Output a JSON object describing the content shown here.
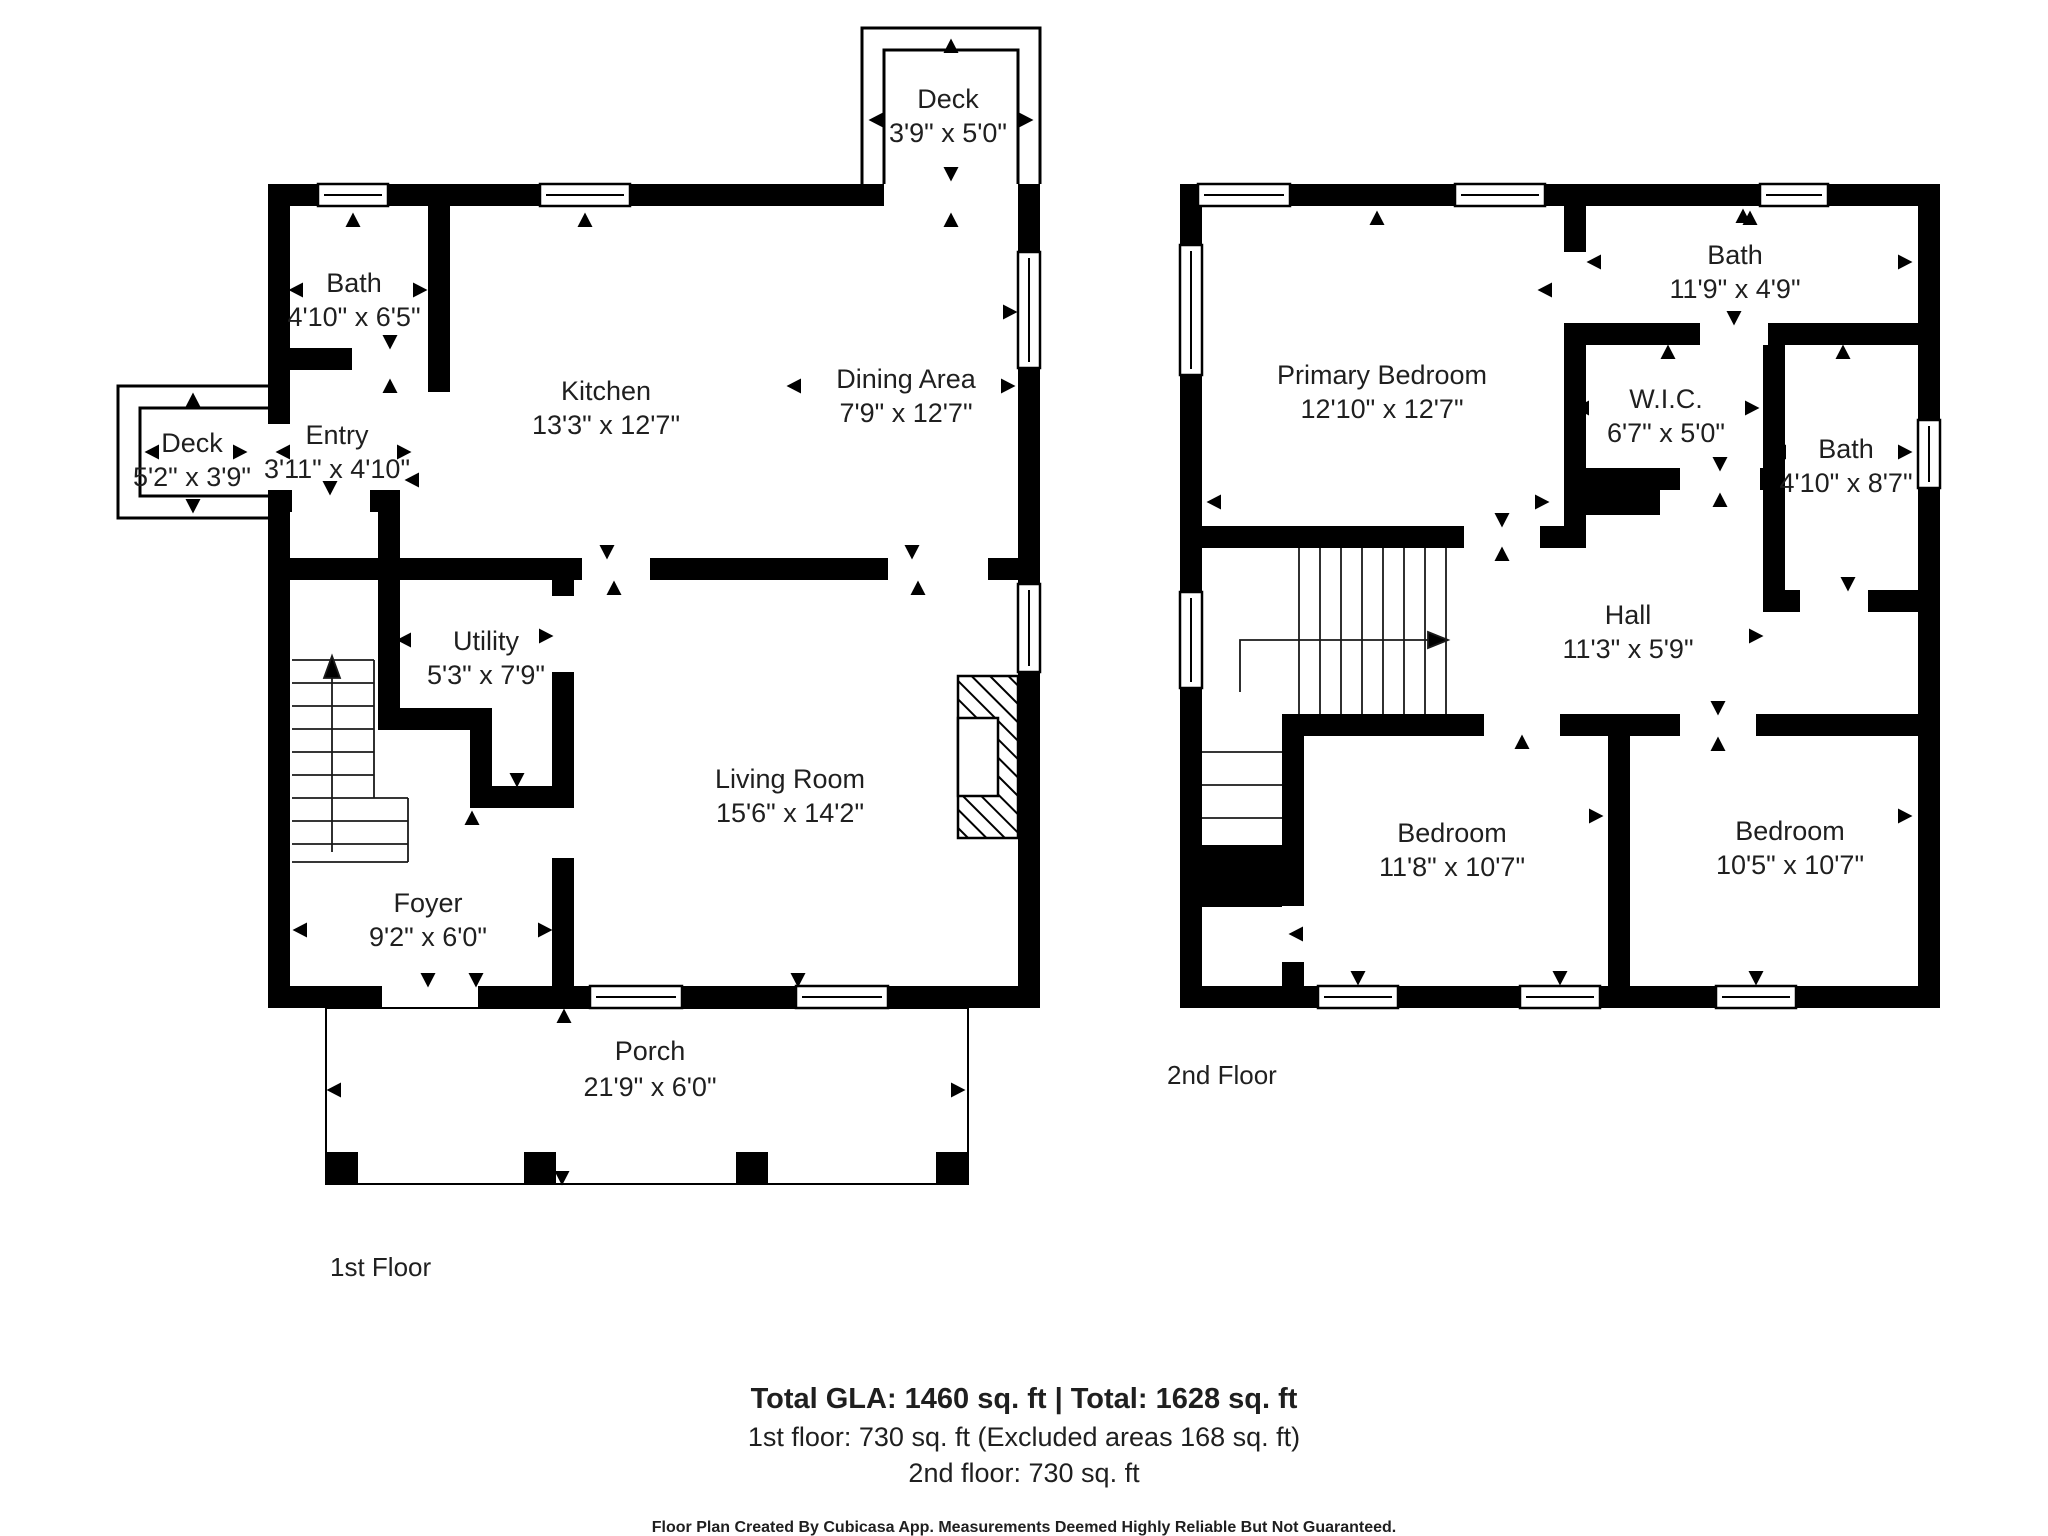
{
  "colors": {
    "wall": "#000000",
    "background": "#ffffff",
    "text": "#1f1f1f"
  },
  "floors": [
    {
      "label": "1st Floor",
      "rooms": [
        {
          "id": "deck-top",
          "name": "Deck",
          "dims": "3'9\" x 5'0\""
        },
        {
          "id": "bath",
          "name": "Bath",
          "dims": "4'10\" x 6'5\""
        },
        {
          "id": "deck-left",
          "name": "Deck",
          "dims": "5'2\" x 3'9\""
        },
        {
          "id": "entry",
          "name": "Entry",
          "dims": "3'11\" x 4'10\""
        },
        {
          "id": "kitchen",
          "name": "Kitchen",
          "dims": "13'3\" x 12'7\""
        },
        {
          "id": "dining",
          "name": "Dining Area",
          "dims": "7'9\" x 12'7\""
        },
        {
          "id": "utility",
          "name": "Utility",
          "dims": "5'3\" x 7'9\""
        },
        {
          "id": "living",
          "name": "Living Room",
          "dims": "15'6\" x 14'2\""
        },
        {
          "id": "foyer",
          "name": "Foyer",
          "dims": "9'2\" x 6'0\""
        },
        {
          "id": "porch",
          "name": "Porch",
          "dims": "21'9\" x 6'0\""
        }
      ]
    },
    {
      "label": "2nd Floor",
      "rooms": [
        {
          "id": "primary",
          "name": "Primary Bedroom",
          "dims": "12'10\" x 12'7\""
        },
        {
          "id": "bath-top",
          "name": "Bath",
          "dims": "11'9\" x 4'9\""
        },
        {
          "id": "wic",
          "name": "W.I.C.",
          "dims": "6'7\" x 5'0\""
        },
        {
          "id": "bath-right",
          "name": "Bath",
          "dims": "4'10\" x 8'7\""
        },
        {
          "id": "hall",
          "name": "Hall",
          "dims": "11'3\" x 5'9\""
        },
        {
          "id": "bedroom-left",
          "name": "Bedroom",
          "dims": "11'8\" x 10'7\""
        },
        {
          "id": "bedroom-right",
          "name": "Bedroom",
          "dims": "10'5\" x 10'7\""
        }
      ]
    }
  ],
  "summary": {
    "line1": "Total GLA: 1460 sq. ft | Total: 1628 sq. ft",
    "line2": "1st floor: 730 sq. ft (Excluded areas 168 sq. ft)",
    "line3": "2nd floor: 730 sq. ft"
  },
  "disclaimer": "Floor Plan Created By Cubicasa App. Measurements Deemed Highly Reliable But Not Guaranteed."
}
